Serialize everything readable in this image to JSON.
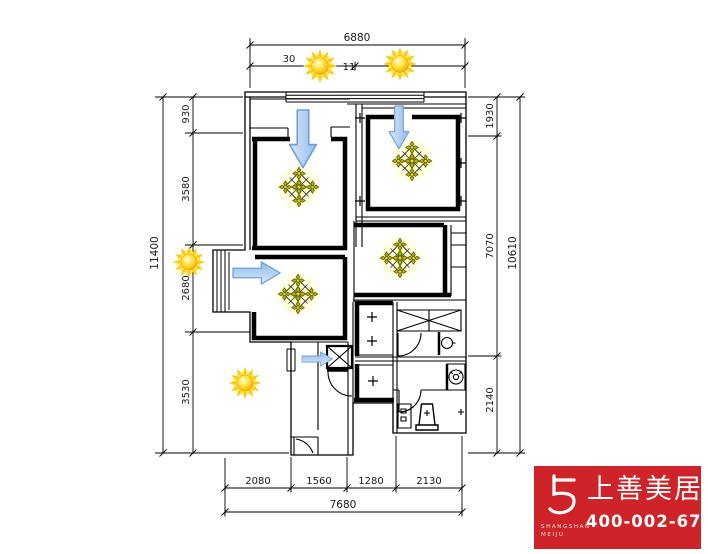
{
  "drawing": {
    "type": "apartment-floor-plan-daylight-diagram",
    "colors": {
      "wall": "#000000",
      "sun_core": "#ffd21f",
      "sun_ray": "#ffcc00",
      "arrow_fill": "#a9c9ec",
      "arrow_stroke": "#6f9fd2",
      "medallion_gold": "#b9b300",
      "logo_red": "#ce2328"
    },
    "icons": [
      "sun-icon",
      "airflow-arrow-icon",
      "ceiling-medallion-icon",
      "column-plus-mark"
    ]
  },
  "dims": {
    "top_total": "6880",
    "top_seg1": "30",
    "top_seg2": "11",
    "left_total": "11400",
    "left_seg1": "930",
    "left_seg2": "3580",
    "left_seg3": "2680",
    "left_seg4": "3530",
    "right_total": "10610",
    "right_seg1": "1930",
    "right_seg2": "7070",
    "right_seg3": "2140",
    "bottom_total": "7680",
    "bottom_seg1": "2080",
    "bottom_seg2": "1560",
    "bottom_seg3": "1280",
    "bottom_seg4": "2130"
  },
  "logo": {
    "brand": "上善美居",
    "latin_line1": "SHANGSHAN",
    "latin_line2": "MEIJU",
    "phone": "400-002-6791"
  }
}
